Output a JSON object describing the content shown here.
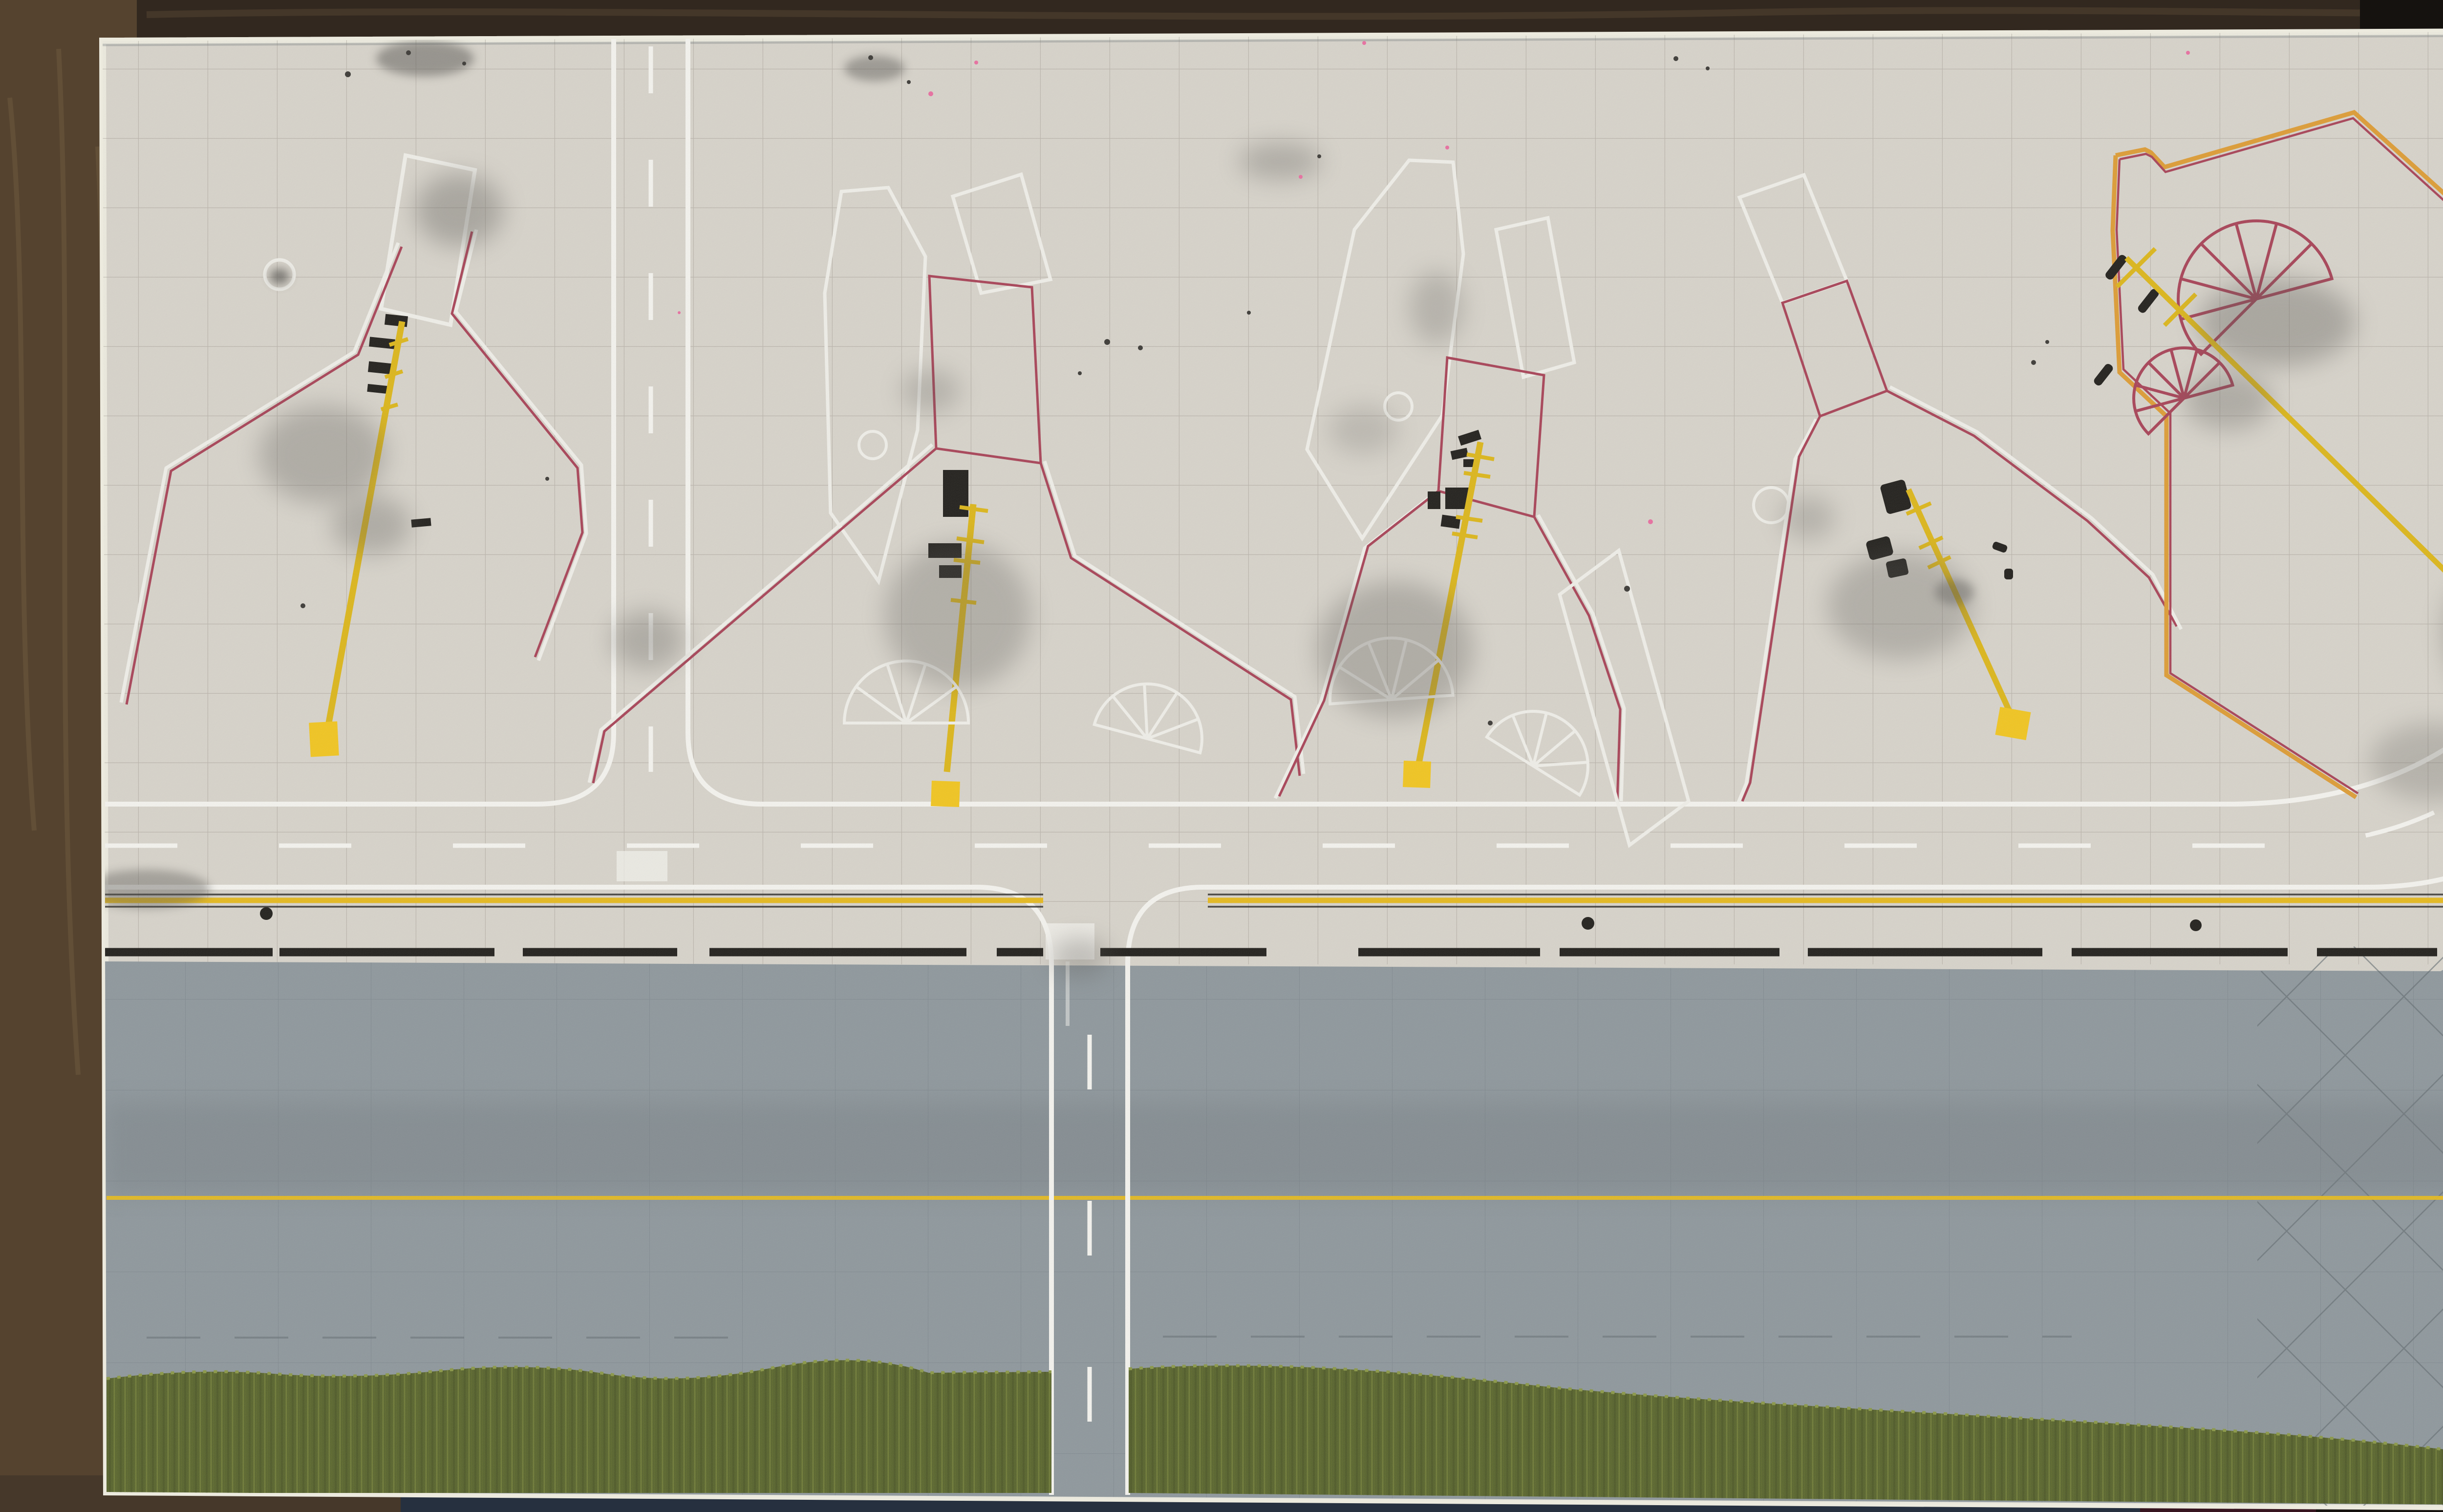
{
  "scene": {
    "subject": "Overhead photograph of a handmade model airport apron diorama board lying on a dark wooden table",
    "board": {
      "surfaces": [
        "concrete-apron",
        "gray-taxiway-strip",
        "grass-verge",
        "painted-edge-face"
      ],
      "stand_count": 5,
      "stands": [
        {
          "id": "stand-1",
          "features": [
            "white-tilted-rectangle",
            "red-white-lead-in-boundary",
            "black-stop-bars",
            "yellow-lead-in-line",
            "yellow-stop-square",
            "white-circle-mark",
            "soot-weathering"
          ]
        },
        {
          "id": "stand-2",
          "features": [
            "white-hexagon-outline",
            "white-tilted-rectangle",
            "red-white-lead-in-boundary",
            "black-stop-bars",
            "yellow-lead-in-line-with-ticks",
            "yellow-stop-square",
            "two-white-fan-markings",
            "white-circle-mark"
          ]
        },
        {
          "id": "stand-3",
          "features": [
            "white-pentagon-outline",
            "white-tilted-rectangle",
            "red-white-lead-in-boundary",
            "black-stop-bars",
            "yellow-lead-in-line-with-ticks",
            "yellow-stop-square",
            "two-white-fan-markings",
            "white-slanted-rectangle",
            "white-circle-mark"
          ]
        },
        {
          "id": "stand-4",
          "features": [
            "white-tilted-rectangle",
            "red-white-lead-in-boundary",
            "black-stop-bars",
            "yellow-lead-in-line-with-ticks",
            "yellow-stop-square",
            "white-circle-mark"
          ]
        },
        {
          "id": "stand-5",
          "features": [
            "orange-red-boundary-polygon",
            "two-red-fan-markings",
            "black-stop-bars",
            "yellow-lead-in-line-with-T-bars",
            "yellow-stop-square"
          ]
        }
      ],
      "roads": {
        "horizontal_service_road": [
          "solid-white-edges",
          "dashed-white-centerline",
          "curves-off-right-edge"
        ],
        "upper_left_road": [
          "vertical",
          "dashed-white-centerline",
          "fillet-junction"
        ],
        "lower_center_road": [
          "vertical",
          "dashed-white-centerline",
          "crosses-gray-strip-to-bottom-edge"
        ],
        "apron_boundary": [
          "yellow-line-with-thin-black-edges",
          "thick-black-dashed-line",
          "three-black-dots"
        ],
        "gray_strip": [
          "solid-yellow-centerline",
          "pencil-diamond-hatching-right",
          "tire-smudges"
        ]
      }
    },
    "surroundings": [
      "wood-table-top",
      "wood-table-left",
      "denim-knee-bottom",
      "dark-red-floor-patch",
      "honeycomb-fabric-bottom-right"
    ]
  },
  "palette": {
    "wood_top": "#32281f",
    "wood_left": "#55432f",
    "wood_bottom": "#46382a",
    "denim": "#26303f",
    "maroon": "#371520",
    "dark": "#15120f",
    "honeycomb_base": "#4e4234",
    "honeycomb_line": "#6e604c",
    "board_cream": "#d7d3ca",
    "board_edge": "#eceade",
    "taxiway_gray": "#8e979c",
    "grass_dark": "#57632b",
    "grass_mid": "#66722f",
    "grass_light": "#8a9846",
    "marking_white": "#f4f3ee",
    "gate_white": "#efeee8",
    "line_red": "#a84357",
    "line_orange": "#dd9c35",
    "lead_yellow": "#dcb61a",
    "stop_yellow": "#f1c51f",
    "boundary_yellow": "#e5b91e",
    "black_mark": "#211f1b",
    "pencil": "#a39d93",
    "pencil_dark": "#5f696e",
    "smudge": "#55534f",
    "pink_speck": "#e86fa0"
  }
}
